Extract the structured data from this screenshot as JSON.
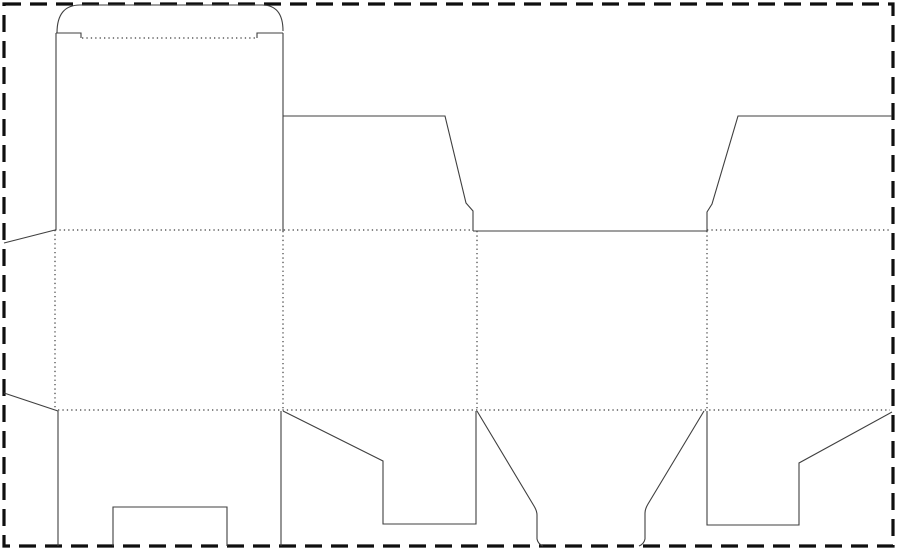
{
  "meta": {
    "title": "box-dieline-template",
    "description": "Die-cut packaging template: cut lines solid, fold lines dotted, page edge dashed"
  },
  "canvas": {
    "width": 900,
    "height": 552,
    "background": "#ffffff"
  },
  "page_border": {
    "x": 4,
    "y": 4,
    "width": 889,
    "height": 542,
    "color": "#0f0f0f",
    "thickness": 3.2,
    "dash_pattern": "17 9"
  },
  "line_styles": {
    "cut": {
      "color": "#3f3f3f",
      "width": 1.1,
      "dash_pattern": ""
    },
    "fold": {
      "color": "#3c3c3c",
      "width": 1.2,
      "dash_pattern": "1.3 3.1"
    }
  },
  "cut_lines": [
    {
      "name": "tuck-flap-arc",
      "d": "M 57 33 Q 57 5 80 5 L 262 5 Q 283 5 283 31"
    },
    {
      "name": "top-shoulder-left",
      "d": "M 56 33 L 81 33 L 81 38"
    },
    {
      "name": "top-shoulder-right",
      "d": "M 257 38 L 257 33 L 283 33"
    },
    {
      "name": "panel1-left-edge",
      "d": "M 56 33 L 56 230"
    },
    {
      "name": "panel1-right-edge",
      "d": "M 283 33 L 283 231"
    },
    {
      "name": "top-flap-left-trapezoid",
      "d": "M 283 116 L 445 116 L 466 203 L 473 211 L 473 231"
    },
    {
      "name": "top-center-cut",
      "d": "M 473 231 L 707 231"
    },
    {
      "name": "top-flap-right-trapezoid",
      "d": "M 707 231 L 707 212 L 712 204 L 738 116 L 892 116"
    },
    {
      "name": "glue-flap-top-edge",
      "d": "M 4 243 L 55 230"
    },
    {
      "name": "glue-flap-bottom-edge",
      "d": "M 4 393 L 58 411"
    },
    {
      "name": "bottom-flap1-left-edge",
      "d": "M 58 411 L 58 546"
    },
    {
      "name": "bottom-flap1-right-edge",
      "d": "M 281 411 L 281 546"
    },
    {
      "name": "bottom-flap1-lock-slot",
      "d": "M 113 546 L 113 507 L 227 507 L 227 546"
    },
    {
      "name": "bottom-dust-flap-left",
      "d": "M 283 411 L 383 461 L 383 524 L 476 524 L 476 411"
    },
    {
      "name": "bottom-tongue-left-edge",
      "d": "M 477 411 L 534 506 Q 537 511 537 515 L 537 539 Q 538 544 543 546"
    },
    {
      "name": "bottom-tongue-right-edge",
      "d": "M 704 411 L 648 504 Q 645 509 645 513 L 645 539 Q 644 544 639 546"
    },
    {
      "name": "bottom-dust-flap-right",
      "d": "M 707 411 L 707 525 L 799 525 L 799 463 L 892 412"
    }
  ],
  "fold_lines": [
    {
      "name": "fold-tuck-flap",
      "d": "M 82 38 L 256 38"
    },
    {
      "name": "fold-top-left-span",
      "d": "M 55 230 L 473 230"
    },
    {
      "name": "fold-top-right-span",
      "d": "M 707 230 L 890 230"
    },
    {
      "name": "fold-bottom-span",
      "d": "M 58 410 L 890 410"
    },
    {
      "name": "fold-vertical-glue",
      "d": "M 55 230 L 55 410"
    },
    {
      "name": "fold-vertical-panel2",
      "d": "M 283 231 L 283 410"
    },
    {
      "name": "fold-vertical-panel3",
      "d": "M 477 231 L 477 410"
    },
    {
      "name": "fold-vertical-panel4",
      "d": "M 707 231 L 707 410"
    }
  ]
}
